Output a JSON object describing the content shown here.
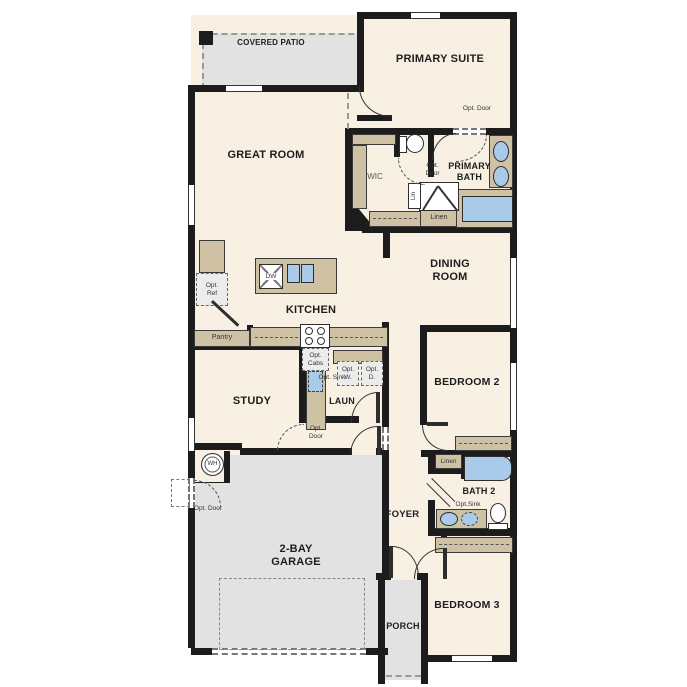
{
  "plan_title": "single-story floor plan",
  "labels": {
    "covered_patio": "COVERED PATIO",
    "primary_suite": "PRIMARY SUITE",
    "great_room": "GREAT ROOM",
    "wic": "WIC",
    "primary_bath": "PRIMARY BATH",
    "opt_door": "Opt. Door",
    "lin": "Lin",
    "linen": "Linen",
    "dining_room": "DINING ROOM",
    "kitchen": "KITCHEN",
    "dw": "DW",
    "opt_ref": "Opt. Ref",
    "pantry": "Pantry",
    "opt_cabs": "Opt. Cabs",
    "opt_sink": "Opt. Sink",
    "opt_w": "Opt. W.",
    "opt_d": "Opt. D.",
    "laun": "LAUN",
    "study": "STUDY",
    "bedroom2": "BEDROOM 2",
    "bath2": "BATH 2",
    "opt_sink2": "Opt.Sink",
    "foyer": "FOYER",
    "wh": "WH",
    "garage": "2-BAY GARAGE",
    "porch": "PORCH",
    "bedroom3": "BEDROOM 3"
  },
  "colors": {
    "floor": "#f8f0e2",
    "outdoor": "#e2e2e2",
    "wall": "#1c1c1c",
    "cabinet": "#cfc2a4",
    "fixture": "#a9cbe9",
    "optfill": "#ececec"
  }
}
